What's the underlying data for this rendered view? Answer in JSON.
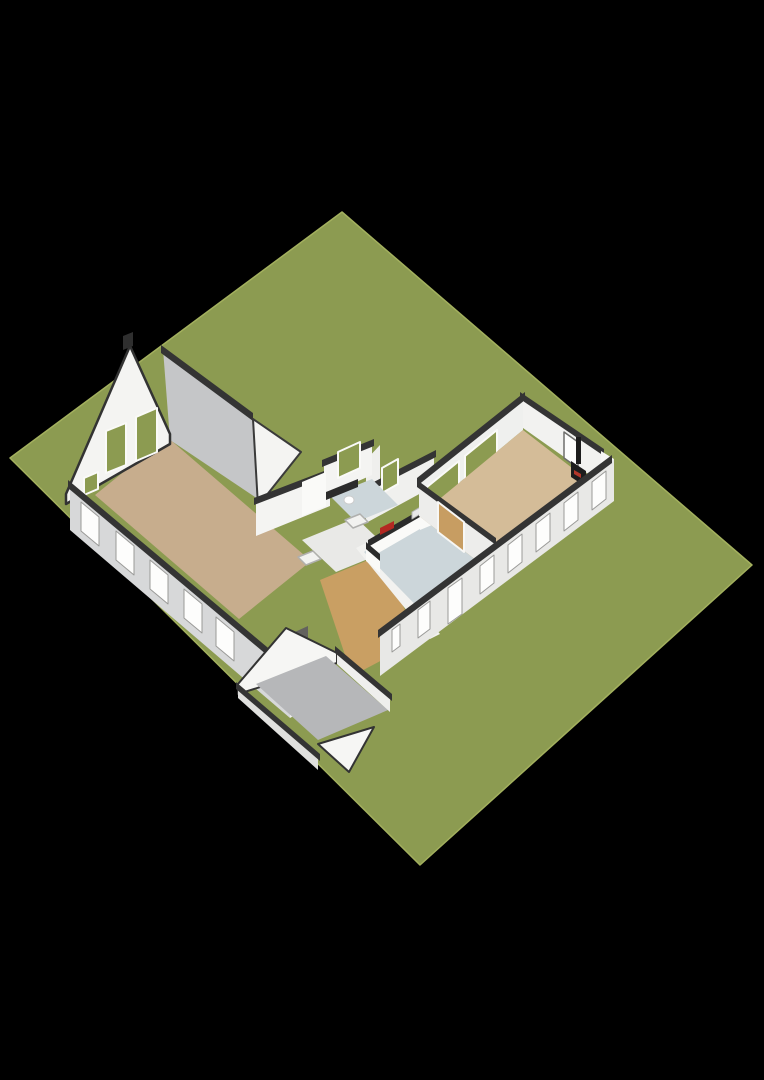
{
  "canvas": {
    "width": 764,
    "height": 1080,
    "background": "#000000"
  },
  "meta": {
    "description": "3D isometric floor plan of a single-storey house with barn room, kitchen corridor, living wing with wood stove, and detached-style shed on a green plot"
  },
  "palette": {
    "grass": "#8c9b51",
    "grass_edge": "#a3b05e",
    "wall_white": "#f4f4f2",
    "wall_light": "#efefed",
    "wall_shade": "#d7d8d9",
    "wall_gray": "#c5c6c8",
    "cap_dark": "#343434",
    "floor_barn": "#c7ad8d",
    "floor_wing": "#d4bc98",
    "floor_wood": "#c99f63",
    "floor_kitchen": "#ccd6da",
    "floor_hall": "#e9e9e7",
    "floor_shed": "#b6b7b9",
    "glass_green": "#8c9b51",
    "door_wood": "#c79d62",
    "counter_dark": "#2b2b2b",
    "cooktop_red": "#b32822",
    "stove_black": "#1d1d1d"
  },
  "scene": {
    "shapes": [
      {
        "name": "grass-plot",
        "type": "polygon",
        "points": "342,212 752,565 420,865 10,458",
        "fill": "#8c9b51",
        "stroke": "#a3b05e",
        "strokeWidth": 1.5
      },
      {
        "name": "barn-floor",
        "type": "polygon",
        "points": "95,495 167,437 311,561 239,619",
        "fill": "#c7ad8d"
      },
      {
        "name": "barn-ne-tall-wall",
        "type": "polygon",
        "points": "163,349 252,417 258,499 170,440",
        "fill": "#c5c6c8"
      },
      {
        "name": "barn-ne-wall-cap",
        "type": "polygon",
        "points": "161,345 253,413 253,421 161,353",
        "fill": "#343434"
      },
      {
        "name": "corridor-gable-wall",
        "type": "polygon",
        "points": "253,419 301,452 258,506",
        "fill": "#f4f4f2",
        "stroke": "#3a3a3a",
        "strokeWidth": 2
      },
      {
        "name": "corridor-nw-wall",
        "type": "polygon",
        "points": "256,502 330,472 330,506 256,536",
        "fill": "#f4f4f2"
      },
      {
        "name": "corridor-nw-wall-cap",
        "type": "polygon",
        "points": "254,498 332,468 332,475 254,505",
        "fill": "#343434"
      },
      {
        "name": "connector-wall",
        "type": "polygon",
        "points": "366,460 380,445 380,500 366,515",
        "fill": "#efefed"
      },
      {
        "name": "bathroom-nw-wall",
        "type": "polygon",
        "points": "324,464 372,443 372,475 324,496",
        "fill": "#f4f4f2"
      },
      {
        "name": "bathroom-nw-wall-cap",
        "type": "polygon",
        "points": "322,460 374,439 374,446 322,467",
        "fill": "#343434"
      },
      {
        "name": "bathroom-window",
        "type": "polygon",
        "points": "338,452 360,442 360,468 338,478",
        "fill": "#8c9b51",
        "stroke": "#fafaf8",
        "strokeWidth": 2
      },
      {
        "name": "kitchen-nw-wall",
        "type": "polygon",
        "points": "366,491 434,454 434,486 366,523",
        "fill": "#f0f0ee"
      },
      {
        "name": "kitchen-nw-wall-cap",
        "type": "polygon",
        "points": "364,487 436,450 436,457 364,494",
        "fill": "#343434"
      },
      {
        "name": "kitchen-window",
        "type": "polygon",
        "points": "382,468 398,459 398,484 382,493",
        "fill": "#8c9b51",
        "stroke": "#fafaf8",
        "strokeWidth": 2
      },
      {
        "name": "bathroom-floor",
        "type": "polygon",
        "points": "330,496 372,479 398,505 356,522",
        "fill": "#ccd6da"
      },
      {
        "name": "bathroom-vanity",
        "type": "polygon",
        "points": "302,482 326,472 326,506 302,516",
        "fill": "#fafaf8"
      },
      {
        "name": "bathroom-counter",
        "type": "polygon",
        "points": "326,492 358,479 358,487 326,500",
        "fill": "#2c2c2c"
      },
      {
        "name": "toilet",
        "type": "ellipse",
        "cx": 349,
        "cy": 500,
        "rx": 5,
        "ry": 4,
        "fill": "#ffffff",
        "stroke": "#cccccc",
        "strokeWidth": 1
      },
      {
        "name": "hall-floor",
        "type": "polygon",
        "points": "302,540 356,518 390,550 336,572",
        "fill": "#e9e9e7"
      },
      {
        "name": "shower-tray-1",
        "type": "polygon",
        "points": "345,520 360,514 368,522 353,528",
        "fill": "#f2f2f0",
        "stroke": "#b0b0ae",
        "strokeWidth": 1.5
      },
      {
        "name": "shower-tray-2",
        "type": "polygon",
        "points": "298,557 313,551 321,559 306,565",
        "fill": "#f2f2f0",
        "stroke": "#b0b0ae",
        "strokeWidth": 1.5
      },
      {
        "name": "hallway-wood-floor",
        "type": "polygon",
        "points": "320,580 378,556 420,640 352,676",
        "fill": "#c99f63"
      },
      {
        "name": "kitchen-sw-wall",
        "type": "polygon",
        "points": "356,548 366,543 440,634 430,639",
        "fill": "#f2f2f0"
      },
      {
        "name": "kitchen-floor",
        "type": "polygon",
        "points": "419,516 494,574 440,630 364,552",
        "fill": "#ccd6da"
      },
      {
        "name": "kitchen-counter-body",
        "type": "polygon",
        "points": "368,545 432,508 432,522 368,559",
        "fill": "#fafaf8"
      },
      {
        "name": "kitchen-counter-top",
        "type": "polygon",
        "points": "368,540 432,503 432,510 368,547",
        "fill": "#2b2b2b"
      },
      {
        "name": "kitchen-counter-return-body",
        "type": "polygon",
        "points": "366,547 380,559 380,573 366,561",
        "fill": "#fafaf8"
      },
      {
        "name": "kitchen-counter-return-top",
        "type": "polygon",
        "points": "366,542 380,554 380,561 366,549",
        "fill": "#2b2b2b"
      },
      {
        "name": "cooktop",
        "type": "polygon",
        "points": "380,528 394,521 394,528 380,535",
        "fill": "#b32822"
      },
      {
        "name": "kitchen-sink",
        "type": "polygon",
        "points": "412,512 422,506 422,513 412,519",
        "fill": "#e8e8e8",
        "stroke": "#b5b5b3",
        "strokeWidth": 1
      },
      {
        "name": "fridge-body",
        "type": "polygon",
        "points": "420,488 444,478 444,520 420,530",
        "fill": "#fafaf8"
      },
      {
        "name": "fridge-front",
        "type": "polygon",
        "points": "426,489 441,483 441,505 426,511",
        "fill": "#1e1e1e"
      },
      {
        "name": "wing-nw-wall",
        "type": "polygon",
        "points": "419,482 523,396 523,430 419,516",
        "fill": "#eff0ee"
      },
      {
        "name": "wing-nw-wall-cap",
        "type": "polygon",
        "points": "417,478 525,392 525,400 417,486",
        "fill": "#343434"
      },
      {
        "name": "wing-glass-pane-1",
        "type": "polygon",
        "points": "427,487 459,461 459,487 427,513",
        "fill": "#8c9b51",
        "stroke": "#fafaf8",
        "strokeWidth": 2
      },
      {
        "name": "wing-glass-pane-2",
        "type": "polygon",
        "points": "465,456 497,430 497,456 465,482",
        "fill": "#8c9b51",
        "stroke": "#fafaf8",
        "strokeWidth": 2
      },
      {
        "name": "wing-ne-wall",
        "type": "polygon",
        "points": "523,396 601,451 601,483 523,428",
        "fill": "#f2f2f0"
      },
      {
        "name": "wing-ne-wall-cap",
        "type": "polygon",
        "points": "520,392 604,449 604,456 520,399",
        "fill": "#343434"
      },
      {
        "name": "wing-back-door",
        "type": "polygon",
        "points": "564,432 578,442 578,468 564,458",
        "fill": "#fdfdfc",
        "stroke": "#6e6e6c",
        "strokeWidth": 1.5
      },
      {
        "name": "wing-floor",
        "type": "polygon",
        "points": "523,430 598,488 494,574 419,516",
        "fill": "#d4bc98"
      },
      {
        "name": "stove-pipe",
        "type": "polygon",
        "points": "576,437 581,437 581,464 576,464",
        "fill": "#1d1d1d"
      },
      {
        "name": "wood-stove",
        "type": "polygon",
        "points": "571,461 586,471 586,487 571,477",
        "fill": "#1d1d1d"
      },
      {
        "name": "stove-ember",
        "type": "polygon",
        "points": "574,470 581,474 581,478 574,474",
        "fill": "#b3372a"
      },
      {
        "name": "wing-kitchen-partition-wall",
        "type": "polygon",
        "points": "419,484 494,542 494,574 419,516",
        "fill": "#ededeb"
      },
      {
        "name": "wing-kitchen-partition-cap",
        "type": "polygon",
        "points": "417,480 496,538 496,545 417,487",
        "fill": "#343434"
      },
      {
        "name": "partition-wood-doors",
        "type": "polygon",
        "points": "438,502 464,522 464,552 438,532",
        "fill": "#c79d62",
        "stroke": "#f7f7f5",
        "strokeWidth": 2
      },
      {
        "name": "wing-corner-return",
        "type": "polygon",
        "points": "601,451 614,459 614,501 601,483",
        "fill": "#f6f6f4"
      },
      {
        "name": "wing-se-facade",
        "type": "polygon",
        "points": "614,459 380,634 380,676 614,501",
        "fill": "#e8e8e6"
      },
      {
        "name": "wing-se-facade-cap",
        "type": "polygon",
        "points": "612,455 378,630 378,638 612,463",
        "fill": "#343434"
      },
      {
        "name": "se-window-1",
        "type": "polygon",
        "points": "592,482 606,471 606,499 592,510",
        "fill": "#fdfdfc",
        "stroke": "#9a9a98",
        "strokeWidth": 1
      },
      {
        "name": "se-window-2",
        "type": "polygon",
        "points": "564,503 578,492 578,520 564,531",
        "fill": "#fdfdfc",
        "stroke": "#9a9a98",
        "strokeWidth": 1
      },
      {
        "name": "se-window-3",
        "type": "polygon",
        "points": "536,524 550,513 550,541 536,552",
        "fill": "#fdfdfc",
        "stroke": "#9a9a98",
        "strokeWidth": 1
      },
      {
        "name": "se-window-4",
        "type": "polygon",
        "points": "508,545 522,534 522,562 508,573",
        "fill": "#fdfdfc",
        "stroke": "#9a9a98",
        "strokeWidth": 1
      },
      {
        "name": "se-window-5",
        "type": "polygon",
        "points": "480,566 494,555 494,583 480,594",
        "fill": "#fdfdfc",
        "stroke": "#9a9a98",
        "strokeWidth": 1
      },
      {
        "name": "se-glass-door",
        "type": "polygon",
        "points": "448,588 462,578 462,614 448,624",
        "fill": "#fdfdfc",
        "stroke": "#9a9a98",
        "strokeWidth": 1
      },
      {
        "name": "se-window-6",
        "type": "polygon",
        "points": "418,610 430,601 430,629 418,638",
        "fill": "#fdfdfc",
        "stroke": "#9a9a98",
        "strokeWidth": 1
      },
      {
        "name": "se-window-7",
        "type": "polygon",
        "points": "392,630 400,624 400,646 392,652",
        "fill": "#fdfdfc",
        "stroke": "#9a9a98",
        "strokeWidth": 1
      },
      {
        "name": "barn-gable-wall",
        "type": "polygon",
        "points": "66,494 130,346 170,434 170,444 66,504",
        "fill": "#f4f4f2",
        "stroke": "#333333",
        "strokeWidth": 2.5
      },
      {
        "name": "gable-chimney",
        "type": "polygon",
        "points": "123,336 133,332 133,346 123,350",
        "fill": "#2f2f2f"
      },
      {
        "name": "gable-window",
        "type": "polygon",
        "points": "84,495 98,489 98,472 84,478",
        "fill": "#8c9b51",
        "stroke": "#fafaf8",
        "strokeWidth": 2
      },
      {
        "name": "gable-green-door-1",
        "type": "polygon",
        "points": "106,473 126,465 126,423 106,431",
        "fill": "#8c9b51",
        "stroke": "#fafaf8",
        "strokeWidth": 2
      },
      {
        "name": "gable-green-door-2",
        "type": "polygon",
        "points": "136,461 157,452 157,408 136,417",
        "fill": "#8c9b51",
        "stroke": "#fafaf8",
        "strokeWidth": 2
      },
      {
        "name": "barn-sw-facade",
        "type": "polygon",
        "points": "70,484 290,672 290,718 70,530",
        "fill": "#d7d8d9"
      },
      {
        "name": "barn-sw-facade-cap",
        "type": "polygon",
        "points": "68,480 292,668 292,676 68,488",
        "fill": "#343434"
      },
      {
        "name": "sw-window-1",
        "type": "polygon",
        "points": "81,502 99,517 99,546 81,531",
        "fill": "#fdfdfc",
        "stroke": "#9a9a98",
        "strokeWidth": 1
      },
      {
        "name": "sw-window-2",
        "type": "polygon",
        "points": "116,531 134,546 134,575 116,560",
        "fill": "#fdfdfc",
        "stroke": "#9a9a98",
        "strokeWidth": 1
      },
      {
        "name": "sw-window-3",
        "type": "polygon",
        "points": "150,560 168,575 168,604 150,589",
        "fill": "#fdfdfc",
        "stroke": "#9a9a98",
        "strokeWidth": 1
      },
      {
        "name": "sw-window-4",
        "type": "polygon",
        "points": "184,589 202,604 202,633 184,618",
        "fill": "#fdfdfc",
        "stroke": "#9a9a98",
        "strokeWidth": 1
      },
      {
        "name": "sw-window-5",
        "type": "polygon",
        "points": "216,617 234,632 234,661 216,646",
        "fill": "#fdfdfc",
        "stroke": "#9a9a98",
        "strokeWidth": 1
      },
      {
        "name": "entry-recess",
        "type": "polygon",
        "points": "286,636 308,626 308,674 286,684",
        "fill": "#63625e"
      },
      {
        "name": "entry-door",
        "type": "polygon",
        "points": "292,641 303,636 303,668 292,673",
        "fill": "#f8f8f6"
      },
      {
        "name": "facade-end-wall",
        "type": "polygon",
        "points": "290,672 312,662 312,706 290,718",
        "fill": "#efefed"
      },
      {
        "name": "shed-nw-gable-wall",
        "type": "polygon",
        "points": "238,694 238,684 286,628 337,653 337,663",
        "fill": "#f6f6f4",
        "stroke": "#333333",
        "strokeWidth": 2
      },
      {
        "name": "shed-floor",
        "type": "polygon",
        "points": "256,684 326,656 388,710 318,740",
        "fill": "#b6b7b9"
      },
      {
        "name": "shed-ne-wall",
        "type": "polygon",
        "points": "337,650 390,698 390,712 337,664",
        "fill": "#efefed"
      },
      {
        "name": "shed-ne-wall-cap",
        "type": "polygon",
        "points": "335,646 392,694 392,701 335,653",
        "fill": "#343434"
      },
      {
        "name": "shed-sw-wall",
        "type": "polygon",
        "points": "238,686 318,758 318,770 238,698",
        "fill": "#e0e0de"
      },
      {
        "name": "shed-sw-wall-cap",
        "type": "polygon",
        "points": "236,682 320,754 320,761 236,689",
        "fill": "#343434"
      },
      {
        "name": "shed-se-gable-wall",
        "type": "polygon",
        "points": "318,744 374,727 349,772",
        "fill": "#f6f6f4",
        "stroke": "#333333",
        "strokeWidth": 2
      }
    ]
  }
}
